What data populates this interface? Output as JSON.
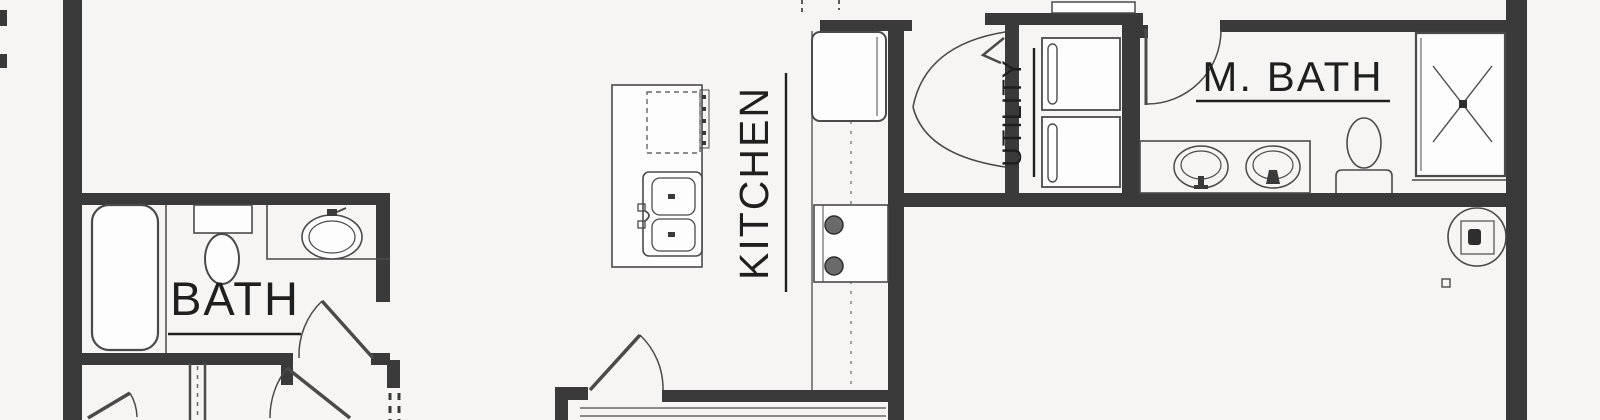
{
  "plan": {
    "title": "floor-plan-crop",
    "colors": {
      "background": "#f6f5f3",
      "wall": "#3a3a3a",
      "fixture_line": "#4a4a4a",
      "text": "#1f1f1f"
    },
    "rooms": [
      {
        "id": "bath",
        "label": "BATH"
      },
      {
        "id": "kitchen",
        "label": "KITCHEN"
      },
      {
        "id": "utility",
        "label": "UTILITY"
      },
      {
        "id": "master_bath",
        "label": "M. BATH"
      }
    ],
    "fixtures": [
      "bathtub",
      "toilet",
      "vanity-sink",
      "kitchen-island",
      "double-sink",
      "dishwasher-dashed",
      "refrigerator",
      "range",
      "washer",
      "dryer",
      "double-vanity-sinks",
      "master-toilet",
      "shower",
      "ceiling-fan",
      "door-swing-arcs",
      "dashed-opening"
    ]
  }
}
